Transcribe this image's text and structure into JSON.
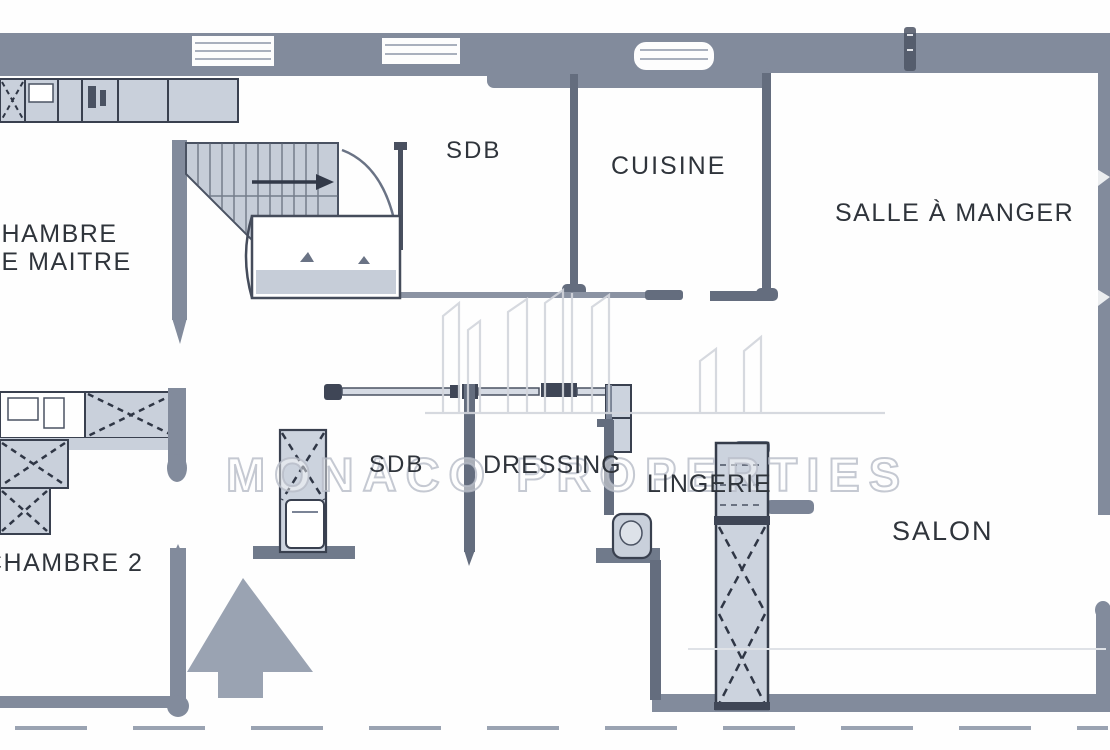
{
  "watermark": {
    "text": "MONACO PROPERTIES"
  },
  "rooms": {
    "chambre_maitre_line1": "CHAMBRE",
    "chambre_maitre_line2": "DE MAITRE",
    "sdb_haut": "SDB",
    "cuisine": "CUISINE",
    "salle_a_manger": "SALLE À MANGER",
    "sdb_bas": "SDB",
    "dressing": "DRESSING",
    "lingerie": "LINGERIE",
    "chambre_2": "CHAMBRE 2",
    "salon": "SALON"
  },
  "colors": {
    "wall": "#828b9c",
    "wall_thin": "#646d7e",
    "wall_dark": "#3f4656",
    "fixture_fill": "#ccd3de",
    "label_text": "#2f343b",
    "watermark_gray": "#c9cdd5",
    "north_arrow": "#9aa3b2"
  }
}
